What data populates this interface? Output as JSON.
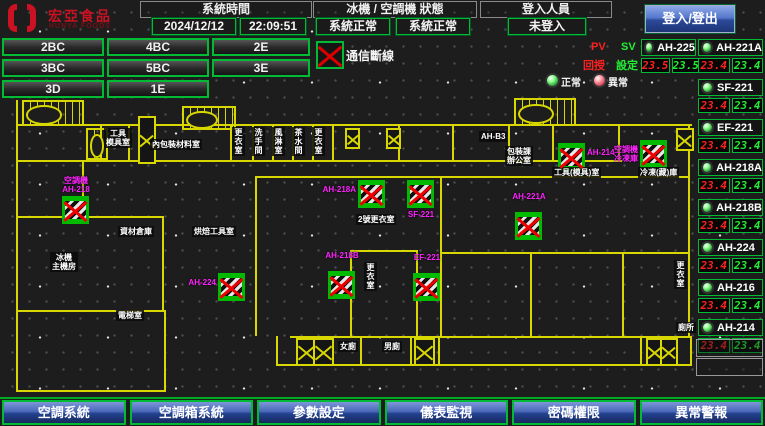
{
  "header": {
    "logo": {
      "title": "宏亞食品",
      "subtitle": "HUNYA FOODS"
    },
    "system_time": {
      "label": "系統時間",
      "date": "2024/12/12",
      "time": "22:09:51"
    },
    "machine_status": {
      "label": "冰機 / 空調機 狀態",
      "chiller": "系統正常",
      "ahu": "系統正常"
    },
    "login": {
      "label": "登入人員",
      "status": "未登入",
      "button": "登入/登出"
    }
  },
  "floor_buttons": [
    "2BC",
    "4BC",
    "2E",
    "3BC",
    "5BC",
    "3E",
    "3D",
    "1E"
  ],
  "legend": {
    "comm_fail": "通信斷線",
    "normal": "正常",
    "abnormal": "異常",
    "pv": "PV",
    "sv": "SV",
    "pv_name": "回授",
    "sv_name": "設定"
  },
  "units_left": [
    {
      "name": "AH-225",
      "pv": "23.5",
      "sv": "23.5"
    }
  ],
  "units_right": [
    {
      "name": "AH-221A",
      "pv": "23.4",
      "sv": "23.4"
    },
    {
      "name": "SF-221",
      "pv": "23.4",
      "sv": "23.4"
    },
    {
      "name": "EF-221",
      "pv": "23.4",
      "sv": "23.4"
    },
    {
      "name": "AH-218A",
      "pv": "23.4",
      "sv": "23.4"
    },
    {
      "name": "AH-218B",
      "pv": "23.4",
      "sv": "23.4"
    },
    {
      "name": "AH-224",
      "pv": "23.4",
      "sv": "23.4"
    },
    {
      "name": "AH-216",
      "pv": "23.4",
      "sv": "23.4"
    },
    {
      "name": "AH-214",
      "pv": "23.4",
      "sv": "23.4"
    }
  ],
  "map": {
    "devices": [
      {
        "name": "AH-218",
        "label": "空調機\nAH-218",
        "x": 62,
        "y": 196,
        "label_pos": "top"
      },
      {
        "name": "AH-218A",
        "label": "AH-218A",
        "x": 358,
        "y": 180,
        "label_pos": "left"
      },
      {
        "name": "SF-221",
        "label": "SF-221",
        "x": 407,
        "y": 180,
        "label_pos": "bottom"
      },
      {
        "name": "AH-214",
        "label": "AH-214",
        "x": 558,
        "y": 143,
        "label_pos": "right"
      },
      {
        "name": "冷凍庫空調機",
        "label": "空調機\n冷凍庫",
        "x": 640,
        "y": 140,
        "label_pos": "left"
      },
      {
        "name": "AH-221A",
        "label": "AH-221A",
        "x": 515,
        "y": 212,
        "label_pos": "top"
      },
      {
        "name": "AH-224",
        "label": "AH-224",
        "x": 218,
        "y": 273,
        "label_pos": "left"
      },
      {
        "name": "AH-218B",
        "label": "AH-218B",
        "x": 328,
        "y": 271,
        "label_pos": "top"
      },
      {
        "name": "EF-221",
        "label": "EF-221",
        "x": 413,
        "y": 273,
        "label_pos": "top"
      }
    ],
    "rooms": [
      {
        "text": "工具\n模具室",
        "x": 104,
        "y": 128,
        "vert": false
      },
      {
        "text": "內包裝材料室",
        "x": 150,
        "y": 139,
        "vert": false
      },
      {
        "text": "更衣室",
        "x": 232,
        "y": 127,
        "vert": true
      },
      {
        "text": "洗手間",
        "x": 252,
        "y": 127,
        "vert": true
      },
      {
        "text": "風淋室",
        "x": 272,
        "y": 127,
        "vert": true
      },
      {
        "text": "茶水間",
        "x": 292,
        "y": 127,
        "vert": true
      },
      {
        "text": "更衣室",
        "x": 312,
        "y": 127,
        "vert": true
      },
      {
        "text": "AH-B3",
        "x": 479,
        "y": 131,
        "vert": false
      },
      {
        "text": "包裝課\n辦公室",
        "x": 505,
        "y": 146,
        "vert": false
      },
      {
        "text": "工具(模具)室",
        "x": 552,
        "y": 167,
        "vert": false
      },
      {
        "text": "冷凍(藏)庫",
        "x": 638,
        "y": 167,
        "vert": false
      },
      {
        "text": "2號更衣室",
        "x": 356,
        "y": 214,
        "vert": false
      },
      {
        "text": "更衣室",
        "x": 364,
        "y": 262,
        "vert": true
      },
      {
        "text": "資材倉庫",
        "x": 118,
        "y": 226,
        "vert": false
      },
      {
        "text": "烘焙工具室",
        "x": 192,
        "y": 226,
        "vert": false
      },
      {
        "text": "冰機\n主機房",
        "x": 50,
        "y": 252,
        "vert": false
      },
      {
        "text": "電梯室",
        "x": 116,
        "y": 310,
        "vert": false
      },
      {
        "text": "女廁",
        "x": 338,
        "y": 341,
        "vert": false
      },
      {
        "text": "男廁",
        "x": 382,
        "y": 341,
        "vert": false
      },
      {
        "text": "更衣室",
        "x": 674,
        "y": 260,
        "vert": true
      },
      {
        "text": "廁所",
        "x": 676,
        "y": 322,
        "vert": false
      }
    ]
  },
  "bottom_menu": [
    "空調系統",
    "空調箱系統",
    "參數設定",
    "儀表監視",
    "密碼權限",
    "異常警報"
  ]
}
